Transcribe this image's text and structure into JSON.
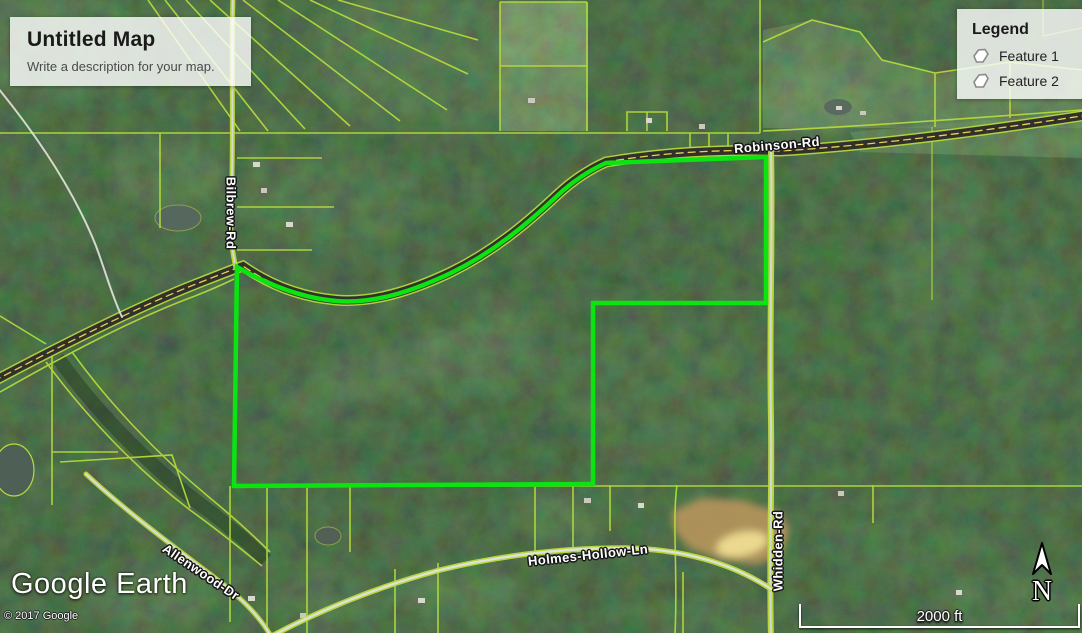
{
  "title_card": {
    "title": "Untitled Map",
    "description": "Write a description for your map."
  },
  "legend": {
    "title": "Legend",
    "items": [
      {
        "label": "Feature 1"
      },
      {
        "label": "Feature 2"
      }
    ]
  },
  "roads": {
    "labels": [
      {
        "name": "Robinson-Rd"
      },
      {
        "name": "Bilbrew-Rd"
      },
      {
        "name": "Whidden-Rd"
      },
      {
        "name": "Holmes-Hollow-Ln"
      },
      {
        "name": "Allenwood-Dr"
      }
    ]
  },
  "attribution": {
    "logo_text": "Google Earth",
    "copyright": "© 2017 Google"
  },
  "scale_bar": {
    "label": "2000 ft"
  },
  "compass": {
    "label": "N"
  },
  "colors": {
    "boundary_green": "#0ae512",
    "parcel_line": "#b9dc3c",
    "road_yellow": "#e6cf58"
  }
}
